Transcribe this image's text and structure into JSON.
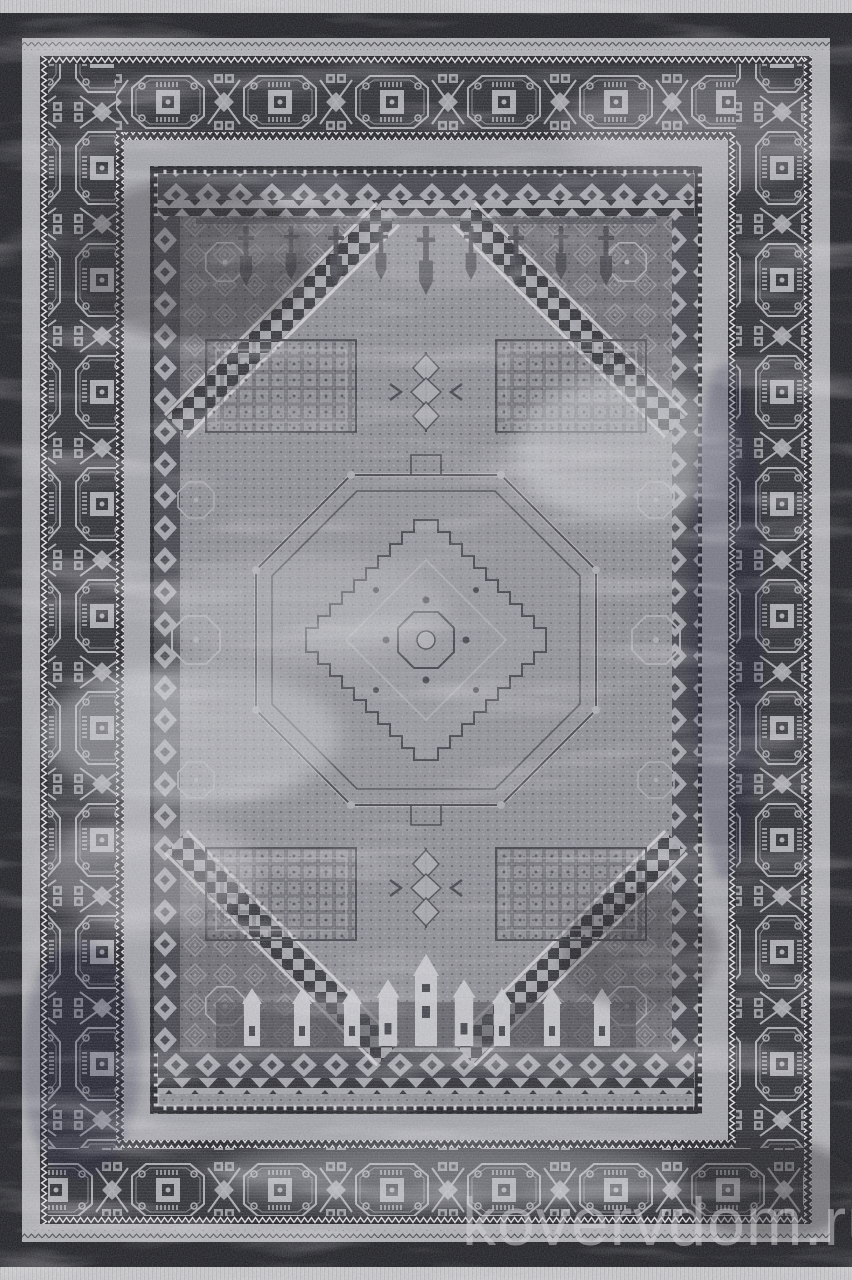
{
  "watermark": {
    "text": "kovervdom.ru"
  },
  "colors": {
    "fringe": "#d7d7d9",
    "black": "#17181c",
    "border_bg": "#24252b",
    "motif": "#aeafb5",
    "white": "#e9e9eb",
    "field": "#8e8f95",
    "field_dark": "#3c3d44",
    "gray_band": "#a7a8ae",
    "bright": "#d0d1d4",
    "watermark": "#d2d2d5"
  }
}
